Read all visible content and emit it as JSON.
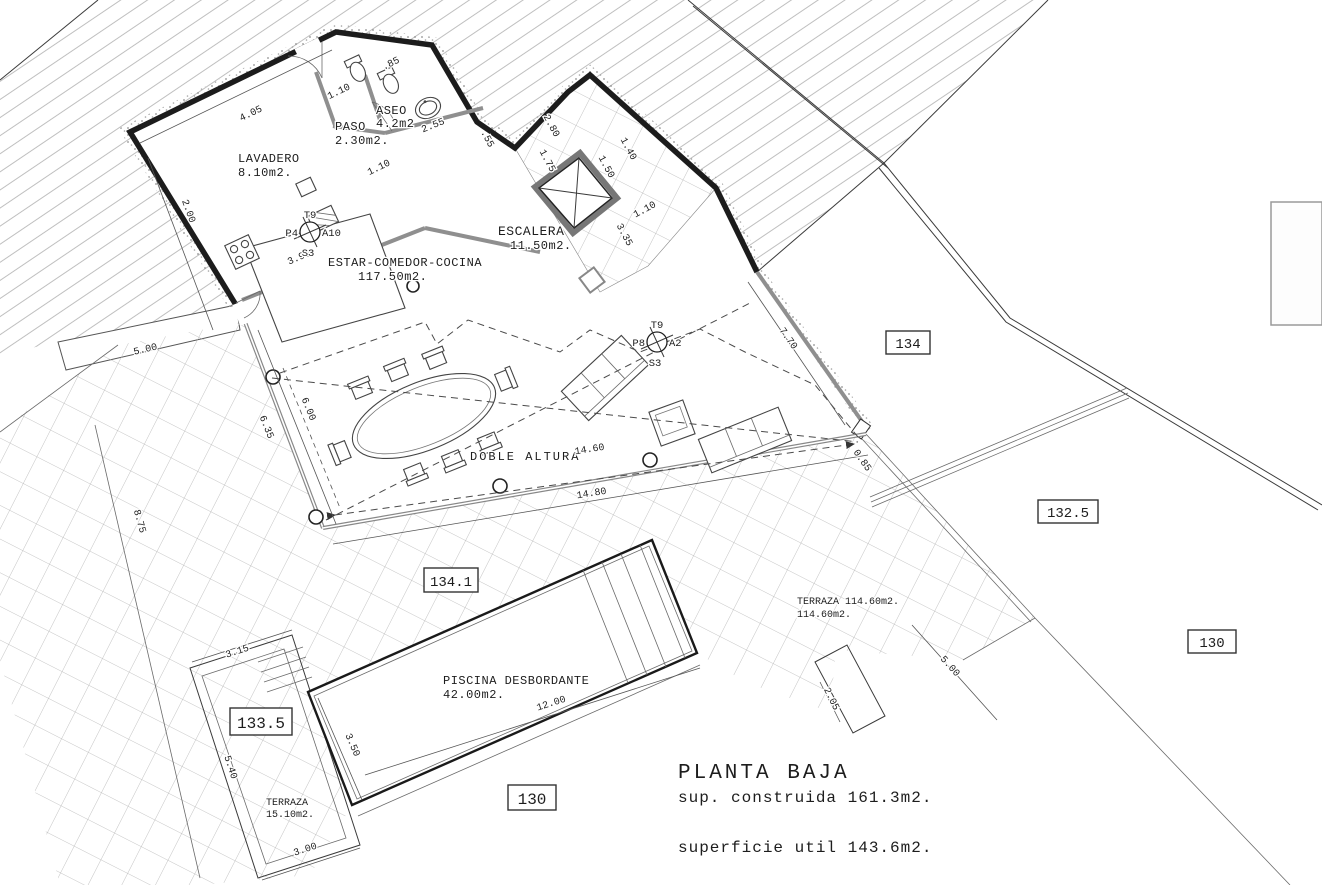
{
  "drawing": {
    "rooms": {
      "lavadero": {
        "name": "LAVADERO",
        "area": "8.10m2."
      },
      "paso": {
        "name": "PASO",
        "area": "2.30m2."
      },
      "aseo": {
        "name": "ASEO",
        "area": "4.2m2"
      },
      "escalera": {
        "name": "ESCALERA",
        "area": "11.50m2."
      },
      "estar": {
        "name": "ESTAR-COMEDOR-COCINA",
        "area": "117.50m2."
      },
      "terraza_principal": {
        "name": "TERRAZA 114.60m2.",
        "area": "114.60m2."
      },
      "terraza_inferior": {
        "name": "TERRAZA",
        "area": "15.10m2."
      },
      "piscina": {
        "name": "PISCINA DESBORDANTE",
        "area": "42.00m2."
      }
    },
    "annotations": {
      "doble_altura": "DOBLE ALTURA"
    },
    "levels": {
      "l134": "134",
      "l132_5": "132.5",
      "l130_right": "130",
      "l134_1": "134.1",
      "l133_5": "133.5",
      "l130_bottom": "130"
    },
    "title_block": {
      "title": "PLANTA BAJA",
      "built_area": "sup. construida 161.3m2.",
      "useful_area": "superficie util 143.6m2."
    },
    "dimensions": {
      "top_wall": "4.05",
      "west_wall": "2.00",
      "kitchen": "3.95",
      "paso_top": "1.10",
      "paso_inner": "1.10",
      "bath": ".85",
      "aseo": "2.55",
      "step": ".55",
      "stair_1": "2.80",
      "stair_2": "1.75",
      "stair_3": "1.50",
      "stair_4": "1.40",
      "stair_5": "1.10",
      "stair_6": "3.35",
      "east_wall": "7.70",
      "corner": "0.85",
      "south_wall": "14.80",
      "doble": "14.60",
      "west_glass_outer": "6.35",
      "west_glass_inner": "6.00",
      "terrace_upper": "5.00",
      "plot_left": "8.75",
      "pool_length": "12.00",
      "pool_width": "3.50",
      "strip_top": "3.15",
      "strip_side": "5.40",
      "strip_bottom": "3.00",
      "terrace_right_a": "2.05",
      "terrace_right_b": "5.00"
    },
    "symbols": {
      "utility_kitchen": {
        "top": "T9",
        "left": "P4",
        "right": "A10",
        "bottom": "S3"
      },
      "utility_living": {
        "top": "T9",
        "left": "P8",
        "right": "A2",
        "bottom": "S3"
      }
    }
  }
}
